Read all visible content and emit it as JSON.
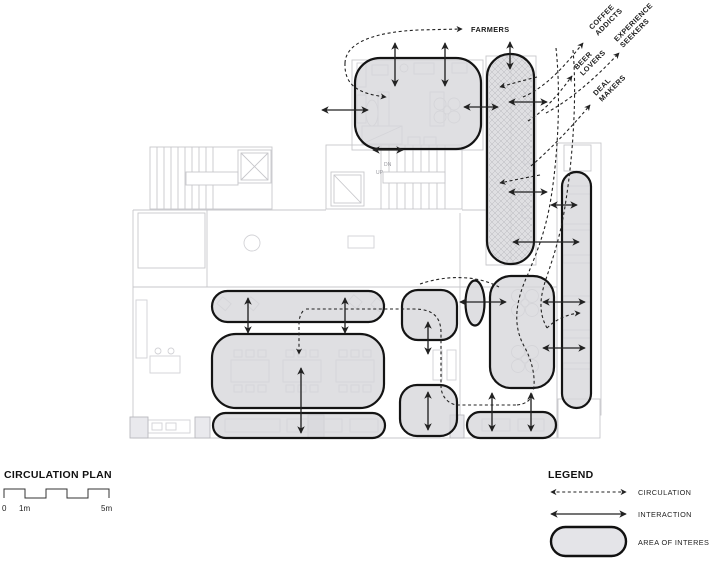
{
  "personas": {
    "farmers": "FARMERS",
    "coffee": {
      "line1": "COFFEE",
      "line2": "ADDICTS"
    },
    "experience": {
      "line1": "EXPERIENCE",
      "line2": "SEEKERS"
    },
    "beer": {
      "line1": "BEER",
      "line2": "LOVERS"
    },
    "deal": {
      "line1": "DEAL",
      "line2": "MAKERS"
    }
  },
  "plan": {
    "stairs_dn": "DN",
    "stairs_up": "UP"
  },
  "footer": {
    "title": "CIRCULATION PLAN",
    "scale_labels": {
      "zero": "0",
      "one": "1m",
      "five": "5m"
    }
  },
  "legend": {
    "title": "LEGEND",
    "circulation": "CIRCULATION",
    "interaction": "INTERACTION",
    "area_of_interest": "AREA OF INTEREST"
  },
  "colors": {
    "background": "#ffffff",
    "area_fill": "#d6d6da",
    "area_outline": "#141414",
    "plan_line": "#c7c7cb",
    "arrow": "#222222"
  }
}
